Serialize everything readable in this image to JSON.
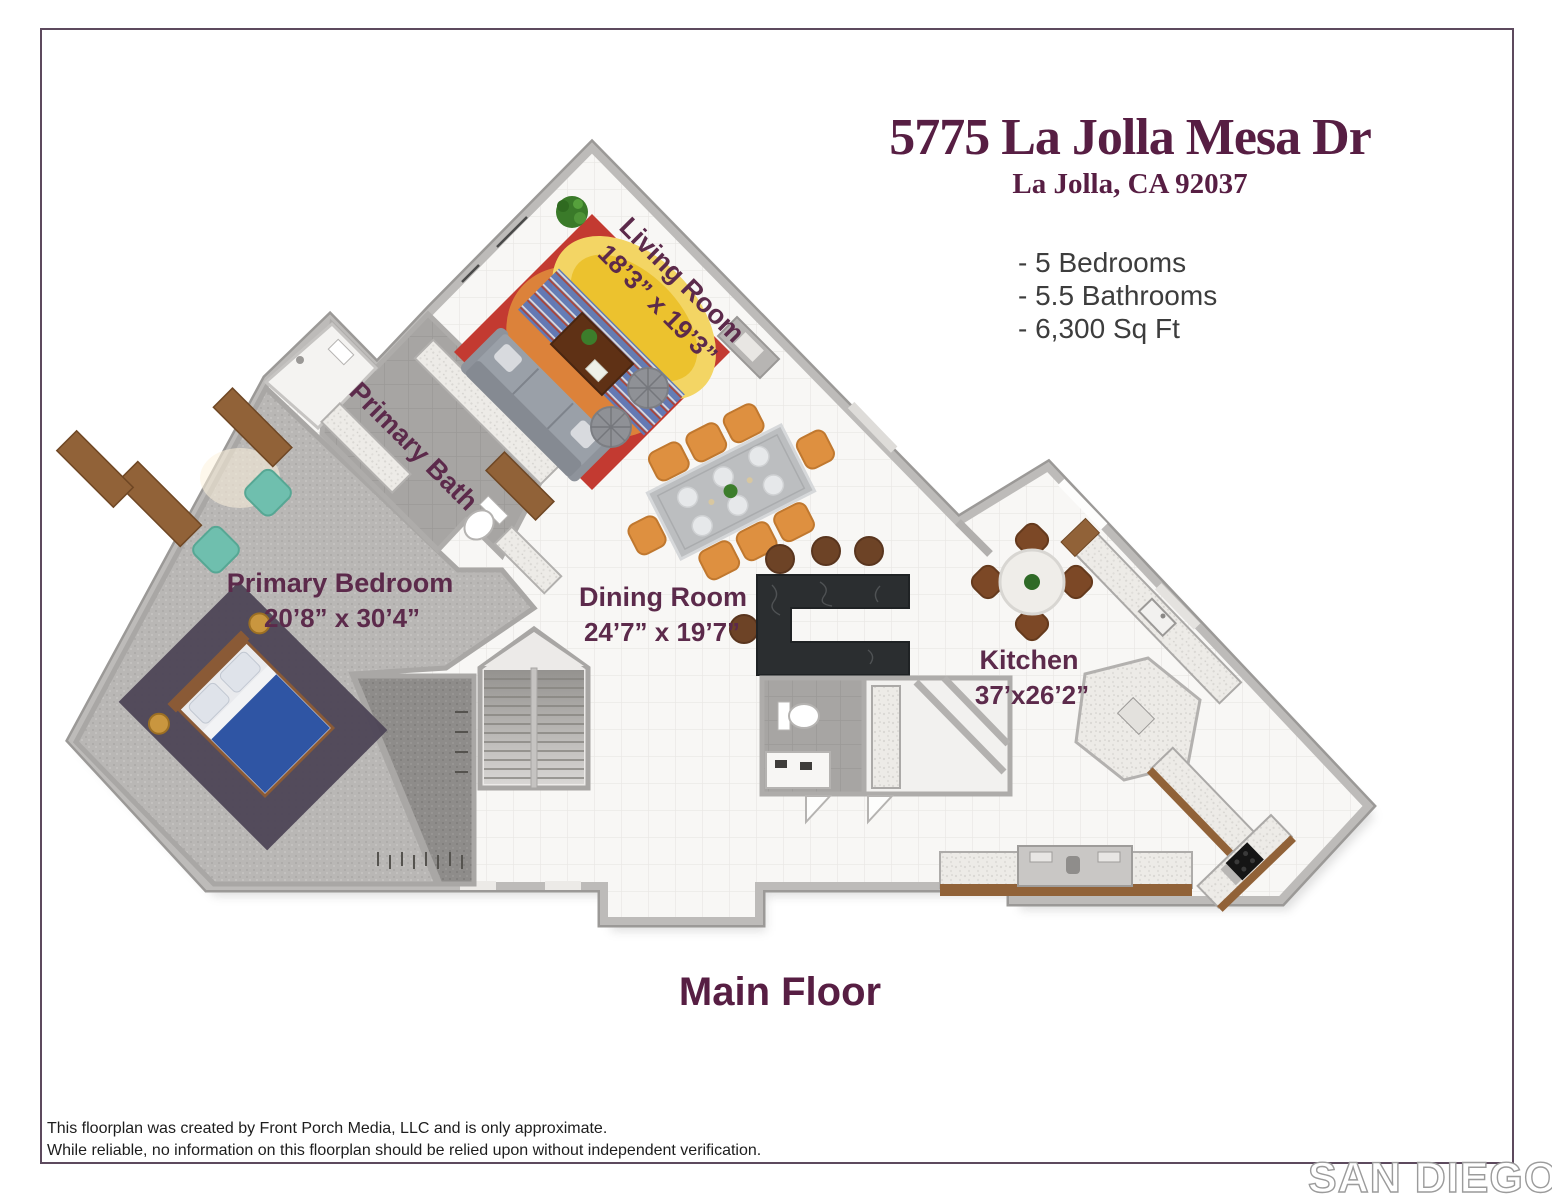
{
  "header": {
    "title": "5775 La Jolla Mesa Dr",
    "subtitle": "La Jolla, CA 92037",
    "specs": [
      "- 5 Bedrooms",
      "- 5.5 Bathrooms",
      "- 6,300 Sq Ft"
    ]
  },
  "floorplan": {
    "floor_label": "Main Floor",
    "rooms": {
      "living": {
        "name": "Living Room",
        "dims": "18’3” x 19’3”"
      },
      "primary_bath": {
        "name": "Primary Bath"
      },
      "primary_bedroom": {
        "name": "Primary Bedroom",
        "dims": "20’8” x 30’4”"
      },
      "dining": {
        "name": "Dining Room",
        "dims": "24’7” x 19’7”"
      },
      "kitchen": {
        "name": "Kitchen",
        "dims": "37’x26’2”"
      }
    }
  },
  "footer": {
    "disclaimer_line1": "This floorplan was created by Front Porch Media, LLC and is only approximate.",
    "disclaimer_line2": "While reliable,  no information on this floorplan should be relied upon without independent verification.",
    "logo": {
      "part1": "SAN DIEGO",
      "part2": "MLS"
    }
  },
  "palette": {
    "accent_purple": "#571e43",
    "label_purple": "#5c2a4b",
    "spec_text": "#3d3d3d",
    "border": "#5d4a5e",
    "wall_gray": "#b1afad",
    "rug_red": "#c33a31",
    "rug_yellow": "#eec02b",
    "rug_orange": "#e08f3c",
    "island_black": "#2b2e30",
    "chair_orange": "#de9040",
    "stool_brown": "#6d4326",
    "counter_wood": "#916238",
    "teal_chair": "#6fbfae",
    "blanket_blue": "#2f55a4",
    "carpet_gray": "#b9b7b5"
  }
}
